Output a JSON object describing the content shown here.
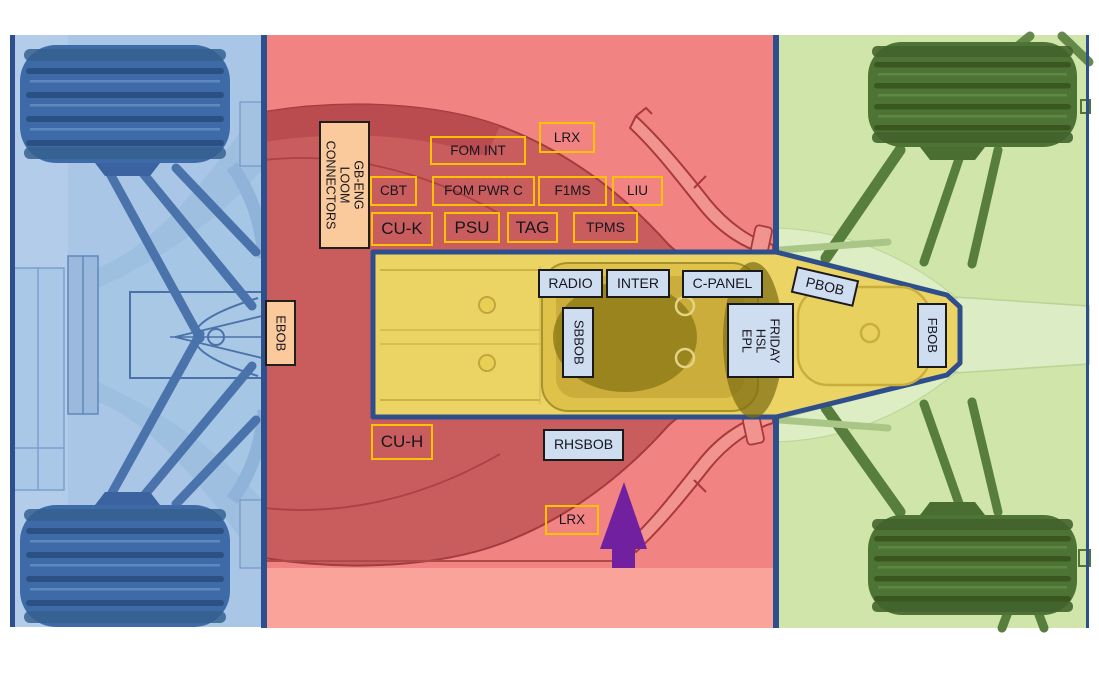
{
  "diagram": {
    "type": "f1-car-component-location-map",
    "arrow": {
      "name": "up-arrow",
      "color": "#71219f"
    },
    "zones": {
      "rear": {
        "color": "#a9c6e7",
        "border": "#2e4f8d"
      },
      "middle": {
        "color": "#f28383",
        "border": "#2e4f8d"
      },
      "front": {
        "color": "#cfe5a9",
        "border": "#2e4f8d"
      },
      "survival_cell": {
        "color": "#ecd464",
        "border": "#2f4f8c"
      }
    }
  },
  "labels": [
    {
      "id": "gb-eng-loom-connectors",
      "lines": [
        "GB-ENG LOOM",
        "CONNECTORS"
      ],
      "style": "peach",
      "rotate": "cw",
      "x": 319,
      "y": 121,
      "w": 51,
      "h": 128,
      "fs": 12.5
    },
    {
      "id": "lrx-top",
      "text": "LRX",
      "style": "gold",
      "x": 539,
      "y": 122,
      "w": 56,
      "h": 31,
      "fs": 13.5
    },
    {
      "id": "fom-int",
      "text": "FOM INT",
      "style": "gold",
      "x": 430,
      "y": 136,
      "w": 96,
      "h": 29,
      "fs": 13.5
    },
    {
      "id": "cbt",
      "text": "CBT",
      "style": "gold",
      "x": 370,
      "y": 176,
      "w": 47,
      "h": 30,
      "fs": 13.5
    },
    {
      "id": "fom-pwr-c",
      "text": "FOM PWR C",
      "style": "gold",
      "x": 432,
      "y": 176,
      "w": 103,
      "h": 30,
      "fs": 13.5
    },
    {
      "id": "f1ms",
      "text": "F1MS",
      "style": "gold",
      "x": 538,
      "y": 176,
      "w": 69,
      "h": 30,
      "fs": 13.5
    },
    {
      "id": "liu",
      "text": "LIU",
      "style": "gold",
      "x": 612,
      "y": 176,
      "w": 51,
      "h": 30,
      "fs": 13.5
    },
    {
      "id": "cu-k",
      "text": "CU-K",
      "style": "gold",
      "x": 371,
      "y": 212,
      "w": 62,
      "h": 34,
      "fs": 17
    },
    {
      "id": "psu",
      "text": "PSU",
      "style": "gold",
      "x": 444,
      "y": 212,
      "w": 56,
      "h": 31,
      "fs": 17
    },
    {
      "id": "tag",
      "text": "TAG",
      "style": "gold",
      "x": 507,
      "y": 212,
      "w": 51,
      "h": 31,
      "fs": 17
    },
    {
      "id": "tpms",
      "text": "TPMS",
      "style": "gold",
      "x": 573,
      "y": 212,
      "w": 65,
      "h": 31,
      "fs": 14
    },
    {
      "id": "ebob",
      "text": "EBOB",
      "style": "peach",
      "rotate": "cw",
      "x": 265,
      "y": 300,
      "w": 31,
      "h": 66,
      "fs": 13
    },
    {
      "id": "radio",
      "text": "RADIO",
      "style": "blue",
      "x": 538,
      "y": 269,
      "w": 65,
      "h": 29,
      "fs": 14
    },
    {
      "id": "inter",
      "text": "INTER",
      "style": "blue",
      "x": 606,
      "y": 269,
      "w": 64,
      "h": 29,
      "fs": 14
    },
    {
      "id": "c-panel",
      "text": "C-PANEL",
      "style": "blue",
      "x": 682,
      "y": 270,
      "w": 81,
      "h": 28,
      "fs": 14
    },
    {
      "id": "pbob",
      "text": "PBOB",
      "style": "blue",
      "x": 793,
      "y": 273,
      "w": 64,
      "h": 27,
      "fs": 14,
      "tilt": 13
    },
    {
      "id": "sbbob",
      "text": "SBBOB",
      "style": "blue",
      "rotate": "cw",
      "x": 562,
      "y": 307,
      "w": 32,
      "h": 71,
      "fs": 13
    },
    {
      "id": "friday-hsl-epl",
      "lines": [
        "FRIDAY",
        "HSL",
        "EPL"
      ],
      "style": "blue",
      "rotate": "cw",
      "x": 727,
      "y": 303,
      "w": 67,
      "h": 75,
      "fs": 12.5
    },
    {
      "id": "fbob",
      "text": "FBOB",
      "style": "blue",
      "rotate": "cw",
      "x": 917,
      "y": 303,
      "w": 30,
      "h": 65,
      "fs": 13
    },
    {
      "id": "cu-h",
      "text": "CU-H",
      "style": "gold",
      "x": 371,
      "y": 424,
      "w": 62,
      "h": 36,
      "fs": 17
    },
    {
      "id": "rhsbob",
      "text": "RHSBOB",
      "style": "blue",
      "x": 543,
      "y": 429,
      "w": 81,
      "h": 32,
      "fs": 14
    },
    {
      "id": "lrx-bottom",
      "text": "LRX",
      "style": "gold",
      "x": 545,
      "y": 505,
      "w": 54,
      "h": 30,
      "fs": 13.5
    }
  ]
}
